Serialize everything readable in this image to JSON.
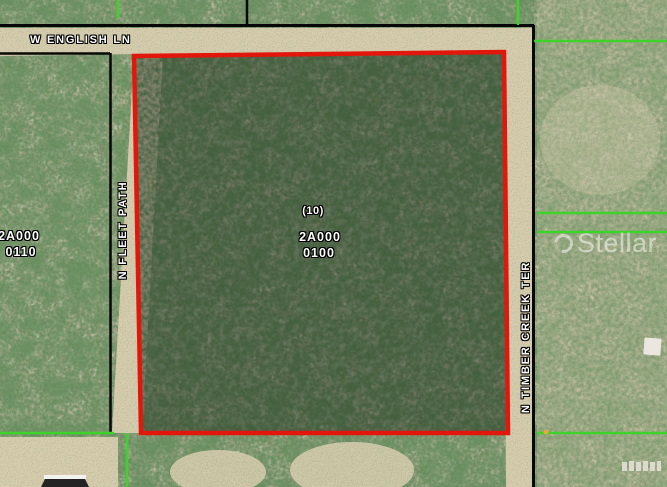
{
  "map": {
    "streets": {
      "english_ln": {
        "label": "W ENGLISH LN"
      },
      "fleet_path": {
        "label": "N FLEET PATH"
      },
      "timber_creek_ter": {
        "label": "N TIMBER CREEK TER"
      }
    },
    "selected_parcel": {
      "lot_number": "(10)",
      "parcel_id_line1": "2A000",
      "parcel_id_line2": "0100"
    },
    "west_parcel": {
      "parcel_id_line1": "2A000",
      "parcel_id_line2": "0110"
    },
    "watermark": {
      "text": "Stellar MLS"
    },
    "colors": {
      "boundary_red": "#e81309",
      "line_black": "#070707",
      "line_green": "#3ed32b",
      "road_sand": "#d6cdae",
      "terrain_base": "#a9a58a",
      "label_text": "#ffffff"
    }
  }
}
